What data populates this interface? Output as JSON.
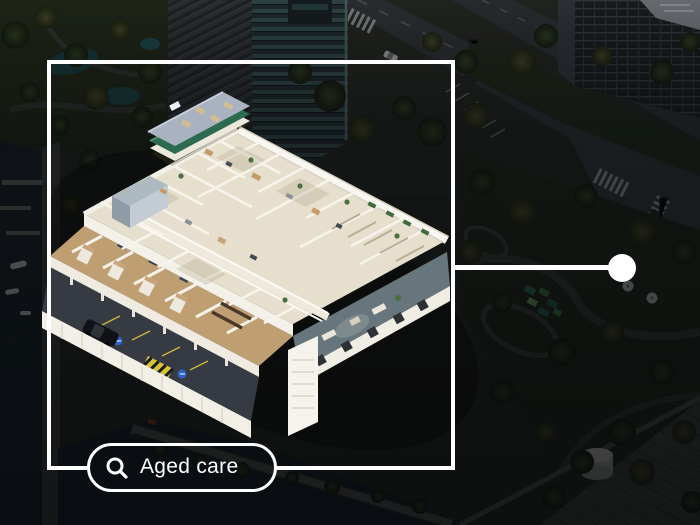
{
  "search_pill": {
    "label": "Aged care",
    "icon": "magnifier-icon"
  },
  "annotation": {
    "type": "focus-frame-with-callout",
    "marker": "location-dot"
  },
  "palette": {
    "overlay_white": "#ffffff",
    "building_cream": "#e9e1cf",
    "building_wall_white": "#f7f5ee",
    "roof_plate_grey": "#a9b2c0",
    "roof_band_teal": "#2d6b50",
    "wood_floor": "#bf9e72",
    "parking_asphalt": "#363b43",
    "hazard_yellow": "#d8c23a",
    "accessible_blue": "#2f62c9",
    "water_dark": "#1d252d",
    "park_green": "#26301f",
    "lounge_slate": "#66767c"
  }
}
